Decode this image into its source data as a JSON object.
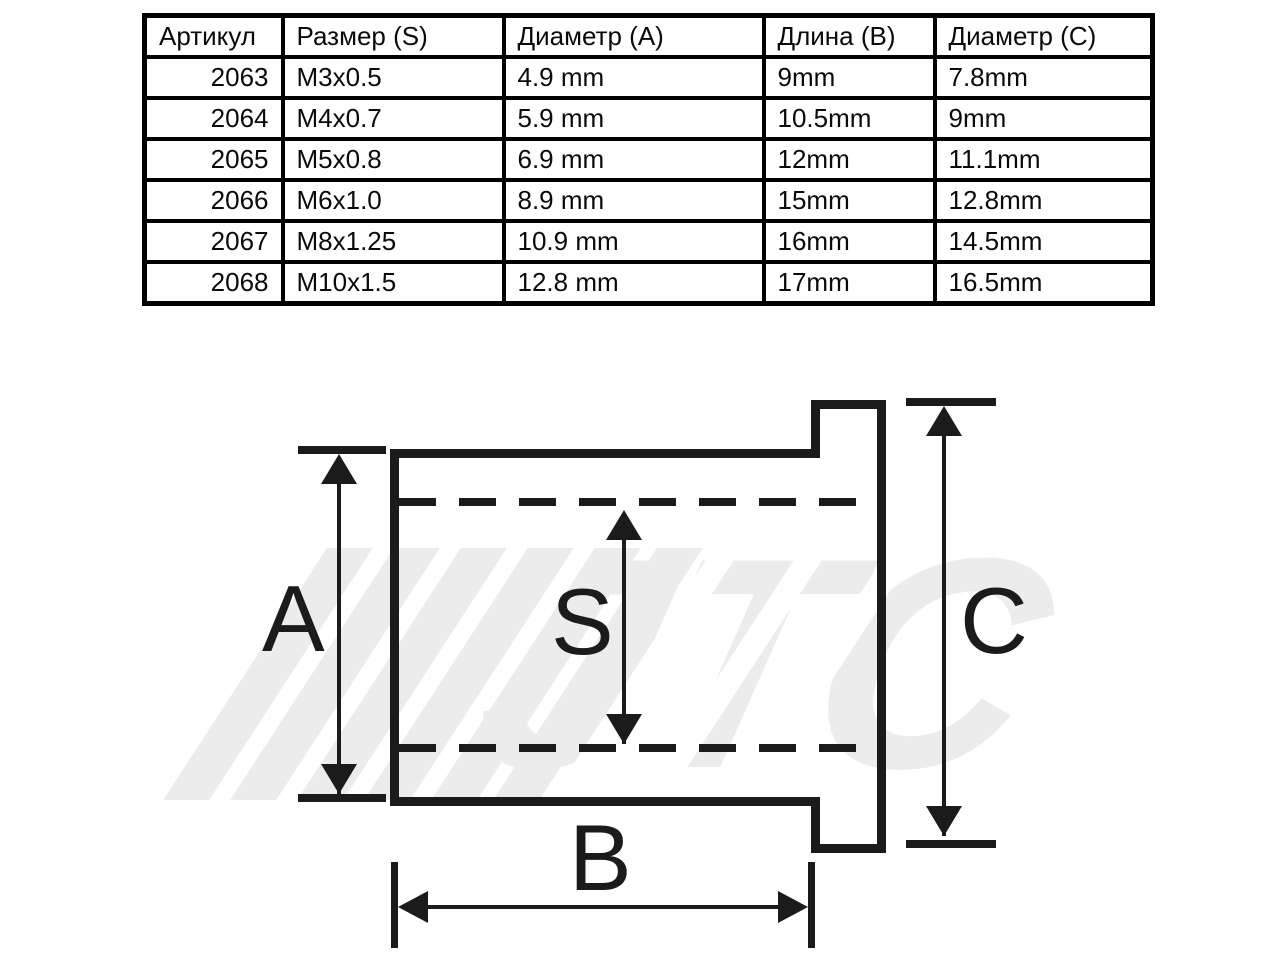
{
  "colors": {
    "ink": "#1b1b1b",
    "table_border": "#000000",
    "watermark_gray": "#ececec"
  },
  "table": {
    "headers": [
      "Артикул",
      "Размер (S)",
      "Диаметр (A)",
      "Длина (B)",
      "Диаметр (C)"
    ],
    "rows": [
      [
        "2063",
        "M3x0.5",
        "4.9 mm",
        "9mm",
        "7.8mm"
      ],
      [
        "2064",
        "M4x0.7",
        "5.9 mm",
        "10.5mm",
        "9mm"
      ],
      [
        "2065",
        "M5x0.8",
        "6.9 mm",
        "12mm",
        "11.1mm"
      ],
      [
        "2066",
        "M6x1.0",
        "8.9 mm",
        "15mm",
        "12.8mm"
      ],
      [
        "2067",
        "M8x1.25",
        "10.9 mm",
        "16mm",
        "14.5mm"
      ],
      [
        "2068",
        "M10x1.5",
        "12.8 mm",
        "17mm",
        "16.5mm"
      ]
    ]
  },
  "diagram": {
    "dimension_labels": {
      "a": "A",
      "s": "S",
      "b": "B",
      "c": "C"
    },
    "watermark_text": "JTC"
  }
}
